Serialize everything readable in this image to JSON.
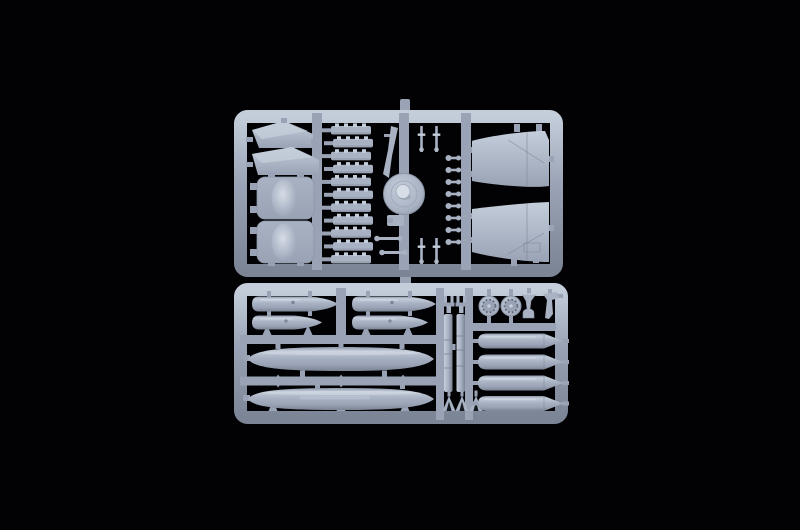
{
  "meta": {
    "description": "Overhead studio photograph of two light blue-grey injection-moulded polystyrene sprues (model aircraft kit runners) centred on a black background. No visible text.",
    "scene_type": "product-photo"
  },
  "colors": {
    "bg": "#020204",
    "hi": "#d7dde7",
    "light": "#c4cdda",
    "mid": "#a8b2c3",
    "base": "#99a3b5",
    "shadow": "#7b8595",
    "edge": "#8b95a6",
    "dark": "#5a6372",
    "hole": "#15181d"
  },
  "sprues": {
    "top_frame": {
      "label": "upper sprue",
      "position": "upper half of photo",
      "parts": [
        {
          "name": "swept fin halves",
          "count": 2
        },
        {
          "name": "bulged panels with domed centres",
          "count": 2
        },
        {
          "name": "stepped rack strips",
          "count": 11
        },
        {
          "name": "slender probe blade",
          "count": 1
        },
        {
          "name": "round disc with centre dome",
          "count": 1
        },
        {
          "name": "thin pin parts",
          "count": 4
        },
        {
          "name": "small clip parts",
          "count": 8
        },
        {
          "name": "tiny antenna rods",
          "count": 2
        },
        {
          "name": "small angle bracket",
          "count": 1
        },
        {
          "name": "large outer wing panels",
          "count": 2
        }
      ]
    },
    "bottom_frame": {
      "label": "lower sprue",
      "position": "lower half of photo",
      "parts": [
        {
          "name": "small drop-tank halves",
          "count": 4
        },
        {
          "name": "large drop-tank halves",
          "count": 2
        },
        {
          "name": "long pylon strips",
          "count": 2
        },
        {
          "name": "pylon clamp fittings",
          "count": 2
        },
        {
          "name": "triangular wedge parts",
          "count": 3
        },
        {
          "name": "wheel hubs with bolt-hole ring",
          "count": 2
        },
        {
          "name": "flared nozzle part",
          "count": 1
        },
        {
          "name": "angled bracket part",
          "count": 1
        },
        {
          "name": "bomb / tank halves",
          "count": 4
        }
      ]
    }
  }
}
